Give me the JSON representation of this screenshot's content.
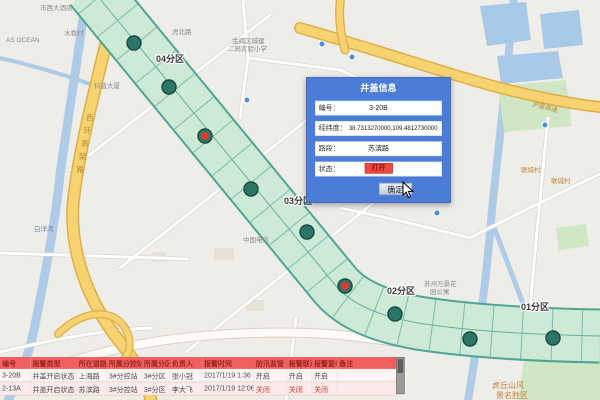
{
  "popup": {
    "title": "井盖信息",
    "fields": [
      {
        "name": "code",
        "label": "编号：",
        "value": "3-20B"
      },
      {
        "name": "coords",
        "label": "经纬度：",
        "value": "38.7313270000,109.4812730000"
      },
      {
        "name": "road",
        "label": "路段：",
        "value": "苏滨路"
      },
      {
        "name": "status",
        "label": "状态：",
        "value": "打开",
        "status": true
      }
    ],
    "confirm_label": "确定"
  },
  "map": {
    "zones": [
      {
        "label": "04分区",
        "x": 156,
        "y": 62
      },
      {
        "label": "03分区",
        "x": 284,
        "y": 204
      },
      {
        "label": "02分区",
        "x": 387,
        "y": 294
      },
      {
        "label": "01分区",
        "x": 521,
        "y": 310
      }
    ],
    "markers": [
      {
        "id": "m1",
        "x": 134,
        "y": 43,
        "state": "closed"
      },
      {
        "id": "m2",
        "x": 169,
        "y": 87,
        "state": "closed"
      },
      {
        "id": "m3",
        "x": 205,
        "y": 136,
        "state": "open"
      },
      {
        "id": "m4",
        "x": 251,
        "y": 189,
        "state": "closed"
      },
      {
        "id": "m5",
        "x": 307,
        "y": 232,
        "state": "closed"
      },
      {
        "id": "m6",
        "x": 345,
        "y": 286,
        "state": "open"
      },
      {
        "id": "m7",
        "x": 395,
        "y": 314,
        "state": "closed"
      },
      {
        "id": "m8",
        "x": 470,
        "y": 339,
        "state": "closed"
      },
      {
        "id": "m9",
        "x": 553,
        "y": 338,
        "state": "closed"
      }
    ],
    "labels": [
      {
        "text": "市西大酒店",
        "x": 40,
        "y": 10
      },
      {
        "text": "AS OCEAN",
        "x": 6,
        "y": 42
      },
      {
        "text": "水香村",
        "x": 64,
        "y": 35
      },
      {
        "text": "虎北路",
        "x": 172,
        "y": 34
      },
      {
        "text": "金阊区城建",
        "x": 232,
        "y": 43
      },
      {
        "text": "二局实验小学",
        "x": 228,
        "y": 51
      },
      {
        "text": "科普大厦",
        "x": 94,
        "y": 88
      },
      {
        "text": "中国电信",
        "x": 243,
        "y": 242
      },
      {
        "text": "白洋湾",
        "x": 34,
        "y": 231,
        "color": "#6f86a8"
      },
      {
        "text": "苏州万景花",
        "x": 424,
        "y": 286
      },
      {
        "text": "园公寓",
        "x": 430,
        "y": 294
      },
      {
        "text": "联城村",
        "x": 521,
        "y": 172,
        "color": "#c88a3c"
      },
      {
        "text": "联城村",
        "x": 551,
        "y": 183,
        "color": "#c88a3c"
      },
      {
        "text": "沪蓉高速",
        "x": 532,
        "y": 106,
        "color": "#b8862e",
        "rotate": 14
      },
      {
        "text": "西环高架路",
        "x": 86,
        "y": 120,
        "color": "#b8862e",
        "vertical": true
      },
      {
        "text": "虎丘山风",
        "x": 492,
        "y": 388,
        "color": "#c8803a",
        "size": 8
      },
      {
        "text": "景名胜区",
        "x": 496,
        "y": 398,
        "color": "#c8803a",
        "size": 8
      }
    ]
  },
  "table": {
    "headers": [
      "编号",
      "报警类型",
      "所在道路",
      "所属分控站",
      "所属分区",
      "负责人",
      "报警时间",
      "防汛监管",
      "报警联动",
      "报警复核",
      "备注"
    ],
    "rows": [
      {
        "cells": [
          "3-20B",
          "井盖开启状态",
          "上海路",
          "3#分控站",
          "3#分区",
          "张小冠",
          "2017/1/19 1:36",
          "开启",
          "开启",
          "开启",
          ""
        ],
        "alarm": false
      },
      {
        "cells": [
          "2-13A",
          "井盖开启状态",
          "苏滨路",
          "3#分控站",
          "3#分区",
          "李大飞",
          "2017/1/19 12:06",
          "关闭",
          "关闭",
          "关闭",
          ""
        ],
        "alarm": true
      }
    ]
  },
  "colors": {
    "panel_blue": "#4a7cd8",
    "status_red": "#ee4a42",
    "table_header_red": "#f15f5f",
    "alarm_text_red": "#e03428",
    "corridor_fill": "#d9efdb",
    "corridor_edge": "#47a28f",
    "marker_teal": "#2c7668",
    "marker_open_red": "#e0382e"
  }
}
